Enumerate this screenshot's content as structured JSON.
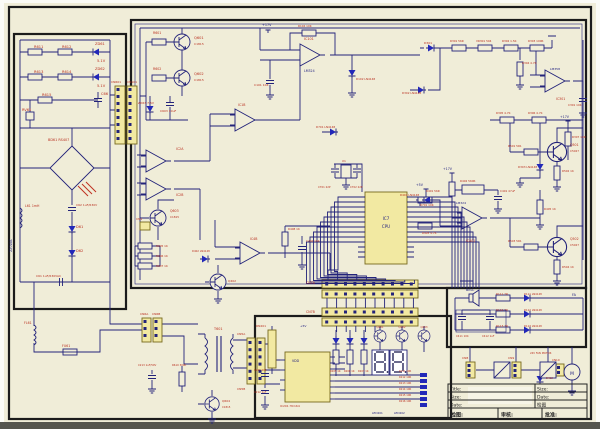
{
  "palette": {
    "bg": "#f0edd8",
    "wire": "#23237a",
    "thick_border": "#1b1b1b",
    "label_red": "#b92f1f",
    "label_blue": "#1a1a7e",
    "ic_fill": "#f2e9a2",
    "diode_blue": "#2228b8",
    "bottom_bar": "#55554e"
  },
  "title_block": {
    "title": "Title:",
    "size": "Size:",
    "date": "Date:",
    "size_r": "Size:",
    "date_r": "Date:",
    "check_r": "检图",
    "check": "检图:",
    "review": "审核:",
    "approve": "批准:"
  },
  "labels": [
    {
      "t": "R611",
      "x": 34,
      "y": 48
    },
    {
      "t": "R612",
      "x": 62,
      "y": 48
    },
    {
      "t": "ZD61",
      "x": 95,
      "y": 45
    },
    {
      "t": "5.1V",
      "x": 97,
      "y": 62
    },
    {
      "t": "R613",
      "x": 34,
      "y": 73
    },
    {
      "t": "R614",
      "x": 62,
      "y": 73
    },
    {
      "t": "ZD62",
      "x": 95,
      "y": 70
    },
    {
      "t": "5.1V",
      "x": 97,
      "y": 87
    },
    {
      "t": "R615",
      "x": 42,
      "y": 96
    },
    {
      "t": "C66",
      "x": 101,
      "y": 95
    },
    {
      "t": "RV61",
      "x": 22,
      "y": 111
    },
    {
      "t": "BD61 RS407",
      "x": 48,
      "y": 141,
      "s": 3.4
    },
    {
      "t": "L61 1mH",
      "x": 25,
      "y": 207,
      "s": 3.2
    },
    {
      "t": "C62 1uF/630V",
      "x": 76,
      "y": 206,
      "s": 3
    },
    {
      "t": "D61",
      "x": 76,
      "y": 228
    },
    {
      "t": "D62",
      "x": 76,
      "y": 252
    },
    {
      "t": "C61 1uF/630VAC",
      "x": 36,
      "y": 277,
      "s": 3
    },
    {
      "t": "220VAC",
      "x": 12,
      "y": 252,
      "c": "b",
      "s": 3.4,
      "r": -90
    },
    {
      "t": "FU61",
      "x": 62,
      "y": 347,
      "s": 3.2
    },
    {
      "t": "FL61",
      "x": 24,
      "y": 324,
      "s": 3.2
    },
    {
      "t": "CN6A",
      "x": 140,
      "y": 315,
      "s": 3
    },
    {
      "t": "CN6B",
      "x": 152,
      "y": 315,
      "s": 3
    },
    {
      "t": "T601",
      "x": 214,
      "y": 330,
      "s": 3.4
    },
    {
      "t": "CN5A",
      "x": 237,
      "y": 335,
      "s": 3
    },
    {
      "t": "CN5B",
      "x": 237,
      "y": 390,
      "s": 3
    },
    {
      "t": "CN601",
      "x": 111,
      "y": 83,
      "s": 3
    },
    {
      "t": "CN101",
      "x": 127,
      "y": 83,
      "s": 3
    },
    {
      "t": "CN1",
      "x": 136,
      "y": 220,
      "s": 3
    },
    {
      "t": "Q601",
      "x": 194,
      "y": 39
    },
    {
      "t": "C1815",
      "x": 194,
      "y": 45,
      "s": 3
    },
    {
      "t": "Q602",
      "x": 194,
      "y": 75
    },
    {
      "t": "C1815",
      "x": 194,
      "y": 81,
      "s": 3
    },
    {
      "t": "R601",
      "x": 153,
      "y": 34,
      "s": 3.2
    },
    {
      "t": "R602",
      "x": 153,
      "y": 70,
      "s": 3.2
    },
    {
      "t": "ZD63 7.5V",
      "x": 138,
      "y": 104,
      "s": 3
    },
    {
      "t": "C603 10uF",
      "x": 160,
      "y": 112,
      "s": 3
    },
    {
      "t": "IC101",
      "x": 304,
      "y": 40,
      "s": 3.4
    },
    {
      "t": "LM324",
      "x": 304,
      "y": 72,
      "c": "b",
      "s": 3.2
    },
    {
      "t": "R104 10K",
      "x": 298,
      "y": 27,
      "s": 2.8
    },
    {
      "t": "D102 LN4148",
      "x": 356,
      "y": 80,
      "s": 2.8
    },
    {
      "t": "C101 104",
      "x": 254,
      "y": 86,
      "s": 3
    },
    {
      "t": "+17V",
      "x": 262,
      "y": 26,
      "c": "b",
      "s": 3.4
    },
    {
      "t": "IC1B",
      "x": 238,
      "y": 106,
      "s": 3.2
    },
    {
      "t": "D701 LN4148",
      "x": 316,
      "y": 128,
      "s": 2.8
    },
    {
      "t": "D301",
      "x": 424,
      "y": 44,
      "s": 3
    },
    {
      "t": "R301 56R",
      "x": 450,
      "y": 42,
      "s": 2.8
    },
    {
      "t": "VR301 504",
      "x": 476,
      "y": 42,
      "s": 2.8
    },
    {
      "t": "R302 1.5K",
      "x": 502,
      "y": 42,
      "s": 2.8
    },
    {
      "t": "R303 100R",
      "x": 528,
      "y": 42,
      "s": 2.8
    },
    {
      "t": "R304 4.7K",
      "x": 522,
      "y": 64,
      "s": 2.8
    },
    {
      "t": "LM358",
      "x": 550,
      "y": 70,
      "c": "b",
      "s": 3
    },
    {
      "t": "IC301",
      "x": 556,
      "y": 100,
      "s": 3.2
    },
    {
      "t": "C301 104",
      "x": 568,
      "y": 106,
      "s": 2.8
    },
    {
      "t": "R305 4.7K",
      "x": 496,
      "y": 114,
      "s": 2.8
    },
    {
      "t": "R306 4.7K",
      "x": 528,
      "y": 114,
      "s": 2.8
    },
    {
      "t": "+17V",
      "x": 560,
      "y": 118,
      "c": "b",
      "s": 3.2
    },
    {
      "t": "R307 10R",
      "x": 572,
      "y": 138,
      "s": 2.8
    },
    {
      "t": "D303 LN4148",
      "x": 518,
      "y": 168,
      "s": 2.8
    },
    {
      "t": "D302 LN4148",
      "x": 402,
      "y": 94,
      "s": 2.8
    },
    {
      "t": "+17V",
      "x": 443,
      "y": 170,
      "c": "b",
      "s": 3.2
    },
    {
      "t": "R401 56R",
      "x": 426,
      "y": 192,
      "s": 2.8
    },
    {
      "t": "R402 560R",
      "x": 460,
      "y": 182,
      "s": 2.8
    },
    {
      "t": "C401 47uF",
      "x": 500,
      "y": 192,
      "s": 2.8
    },
    {
      "t": "LM324",
      "x": 456,
      "y": 204,
      "c": "b",
      "s": 3
    },
    {
      "t": "IC401",
      "x": 466,
      "y": 242,
      "s": 3.2
    },
    {
      "t": "D401 LN4148",
      "x": 400,
      "y": 196,
      "s": 2.8
    },
    {
      "t": "R405 1K",
      "x": 544,
      "y": 210,
      "s": 2.8
    },
    {
      "t": "R403 4.7K",
      "x": 422,
      "y": 234,
      "s": 2.8
    },
    {
      "t": "Q501",
      "x": 570,
      "y": 146,
      "s": 3.2
    },
    {
      "t": "C5027",
      "x": 570,
      "y": 152,
      "s": 2.8
    },
    {
      "t": "Q502",
      "x": 570,
      "y": 240,
      "s": 3.2
    },
    {
      "t": "C5027",
      "x": 570,
      "y": 246,
      "s": 2.8
    },
    {
      "t": "R501 5R1",
      "x": 508,
      "y": 147,
      "s": 2.8
    },
    {
      "t": "R502 1K",
      "x": 562,
      "y": 172,
      "s": 2.8
    },
    {
      "t": "R503 5R1",
      "x": 508,
      "y": 242,
      "s": 2.8
    },
    {
      "t": "R504 1K",
      "x": 562,
      "y": 268,
      "s": 2.8
    },
    {
      "t": "IC7",
      "x": 386,
      "y": 220,
      "c": "b",
      "s": 4,
      "a": "m"
    },
    {
      "t": "CPU",
      "x": 386,
      "y": 228,
      "c": "b",
      "s": 4,
      "a": "m"
    },
    {
      "t": "X1",
      "x": 342,
      "y": 162,
      "s": 3
    },
    {
      "t": "C701 22P",
      "x": 318,
      "y": 188,
      "s": 2.6
    },
    {
      "t": "C702 22P",
      "x": 350,
      "y": 188,
      "s": 2.6
    },
    {
      "t": "+5V",
      "x": 416,
      "y": 186,
      "c": "b",
      "s": 3.2
    },
    {
      "t": "R701 10K",
      "x": 420,
      "y": 206,
      "s": 2.8
    },
    {
      "t": "IC2A",
      "x": 176,
      "y": 150,
      "s": 3.2
    },
    {
      "t": "IC2B",
      "x": 176,
      "y": 196,
      "s": 3.2
    },
    {
      "t": "Q603",
      "x": 170,
      "y": 212,
      "s": 3.2
    },
    {
      "t": "C1815",
      "x": 170,
      "y": 218,
      "s": 2.8
    },
    {
      "t": "R605 1K",
      "x": 156,
      "y": 247,
      "s": 2.8
    },
    {
      "t": "R606 1K",
      "x": 156,
      "y": 257,
      "s": 2.8
    },
    {
      "t": "R607 1K",
      "x": 156,
      "y": 267,
      "s": 2.8
    },
    {
      "t": "IC4B",
      "x": 250,
      "y": 240,
      "s": 3.2
    },
    {
      "t": "D402 LN4148",
      "x": 192,
      "y": 252,
      "s": 2.6
    },
    {
      "t": "Q402",
      "x": 228,
      "y": 282,
      "s": 3
    },
    {
      "t": "R408 1K",
      "x": 288,
      "y": 230,
      "s": 2.8
    },
    {
      "t": "C402 104",
      "x": 306,
      "y": 242,
      "s": 2.8
    },
    {
      "t": "CN7A",
      "x": 306,
      "y": 284,
      "s": 3.2
    },
    {
      "t": "CN7B",
      "x": 306,
      "y": 313,
      "s": 3.2
    },
    {
      "t": "FA",
      "x": 572,
      "y": 296,
      "c": "b",
      "s": 3.4
    },
    {
      "t": "R111 7R",
      "x": 496,
      "y": 295,
      "s": 2.8
    },
    {
      "t": "D111 LN4148",
      "x": 524,
      "y": 295,
      "s": 2.6
    },
    {
      "t": "R112 7R",
      "x": 496,
      "y": 311,
      "s": 2.8
    },
    {
      "t": "D112 LN4148",
      "x": 524,
      "y": 311,
      "s": 2.6
    },
    {
      "t": "R113 7R",
      "x": 496,
      "y": 327,
      "s": 2.8
    },
    {
      "t": "D113 LN4148",
      "x": 524,
      "y": 327,
      "s": 2.6
    },
    {
      "t": "BELL",
      "x": 466,
      "y": 291,
      "c": "b",
      "s": 3.4
    },
    {
      "t": "C411 104",
      "x": 456,
      "y": 337,
      "s": 2.6
    },
    {
      "t": "C412 1uF",
      "x": 482,
      "y": 337,
      "s": 2.6
    },
    {
      "t": "CN8",
      "x": 462,
      "y": 359,
      "s": 3
    },
    {
      "t": "CN9",
      "x": 508,
      "y": 359,
      "s": 3
    },
    {
      "t": "CN10",
      "x": 552,
      "y": 361,
      "s": 2.8
    },
    {
      "t": "24V FAN MOTOR",
      "x": 530,
      "y": 354,
      "s": 2.6
    },
    {
      "t": "M",
      "x": 572,
      "y": 375,
      "c": "b",
      "s": 4.4,
      "a": "m"
    },
    {
      "t": "RN201",
      "x": 256,
      "y": 327,
      "s": 3
    },
    {
      "t": "VDD",
      "x": 292,
      "y": 362,
      "c": "b",
      "s": 3.2
    },
    {
      "t": "IC201 HC164",
      "x": 280,
      "y": 407,
      "s": 3
    },
    {
      "t": "Q201",
      "x": 380,
      "y": 328,
      "s": 2.6,
      "a": "m"
    },
    {
      "t": "Q202",
      "x": 402,
      "y": 328,
      "s": 2.6,
      "a": "m"
    },
    {
      "t": "Q203",
      "x": 424,
      "y": 328,
      "s": 2.6,
      "a": "m"
    },
    {
      "t": "R205 1K",
      "x": 330,
      "y": 372,
      "s": 2.5
    },
    {
      "t": "R206 1K",
      "x": 344,
      "y": 372,
      "s": 2.5
    },
    {
      "t": "R207 1K",
      "x": 358,
      "y": 372,
      "s": 2.5
    },
    {
      "t": "R211 10R",
      "x": 399,
      "y": 372,
      "s": 2.5
    },
    {
      "t": "R212 10R",
      "x": 399,
      "y": 378,
      "s": 2.5
    },
    {
      "t": "R213 10R",
      "x": 399,
      "y": 384,
      "s": 2.5
    },
    {
      "t": "R214 10R",
      "x": 399,
      "y": 390,
      "s": 2.5
    },
    {
      "t": "R215 10R",
      "x": 399,
      "y": 396,
      "s": 2.5
    },
    {
      "t": "R216 10R",
      "x": 399,
      "y": 402,
      "s": 2.5
    },
    {
      "t": "LED201",
      "x": 372,
      "y": 414,
      "c": "b",
      "s": 2.8
    },
    {
      "t": "LED202",
      "x": 394,
      "y": 414,
      "c": "b",
      "s": 2.8
    },
    {
      "t": "C211 104",
      "x": 254,
      "y": 371,
      "s": 2.6
    },
    {
      "t": "C212 1uF",
      "x": 254,
      "y": 393,
      "s": 2.6
    },
    {
      "t": "+5V",
      "x": 300,
      "y": 327,
      "c": "b",
      "s": 3
    },
    {
      "t": "C213 1uF/50V",
      "x": 138,
      "y": 366,
      "s": 2.6
    },
    {
      "t": "R610 300K",
      "x": 172,
      "y": 366,
      "s": 2.6
    },
    {
      "t": "Q604",
      "x": 222,
      "y": 402,
      "s": 3
    },
    {
      "t": "C1815",
      "x": 222,
      "y": 408,
      "s": 2.6
    },
    {
      "t": "D412",
      "x": 546,
      "y": 379,
      "s": 2.6
    }
  ]
}
